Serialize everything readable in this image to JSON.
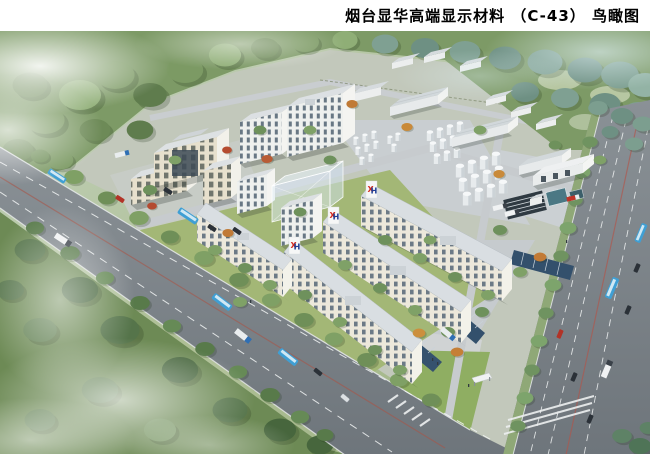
{
  "title": {
    "text": "烟台显华高端显示材料 （C-43） 鸟瞰图"
  },
  "rendering": {
    "description": "Aerial bird's-eye architectural rendering of an industrial campus: white multi-storey buildings with XH logos, workshops, tank farms, lawns and two tree-lined roads surrounded by forest",
    "logo": {
      "x": "X",
      "h": "H",
      "red": "#d42a1e",
      "blue": "#1e3e96"
    },
    "colors": {
      "forest_green": "#6d8a57",
      "forest_teal": "#7fa092",
      "road_gray": "#7d848a",
      "facade_cream": "#ece8db",
      "lawn_green": "#9ab26e",
      "mist_white": "#ffffff"
    }
  }
}
